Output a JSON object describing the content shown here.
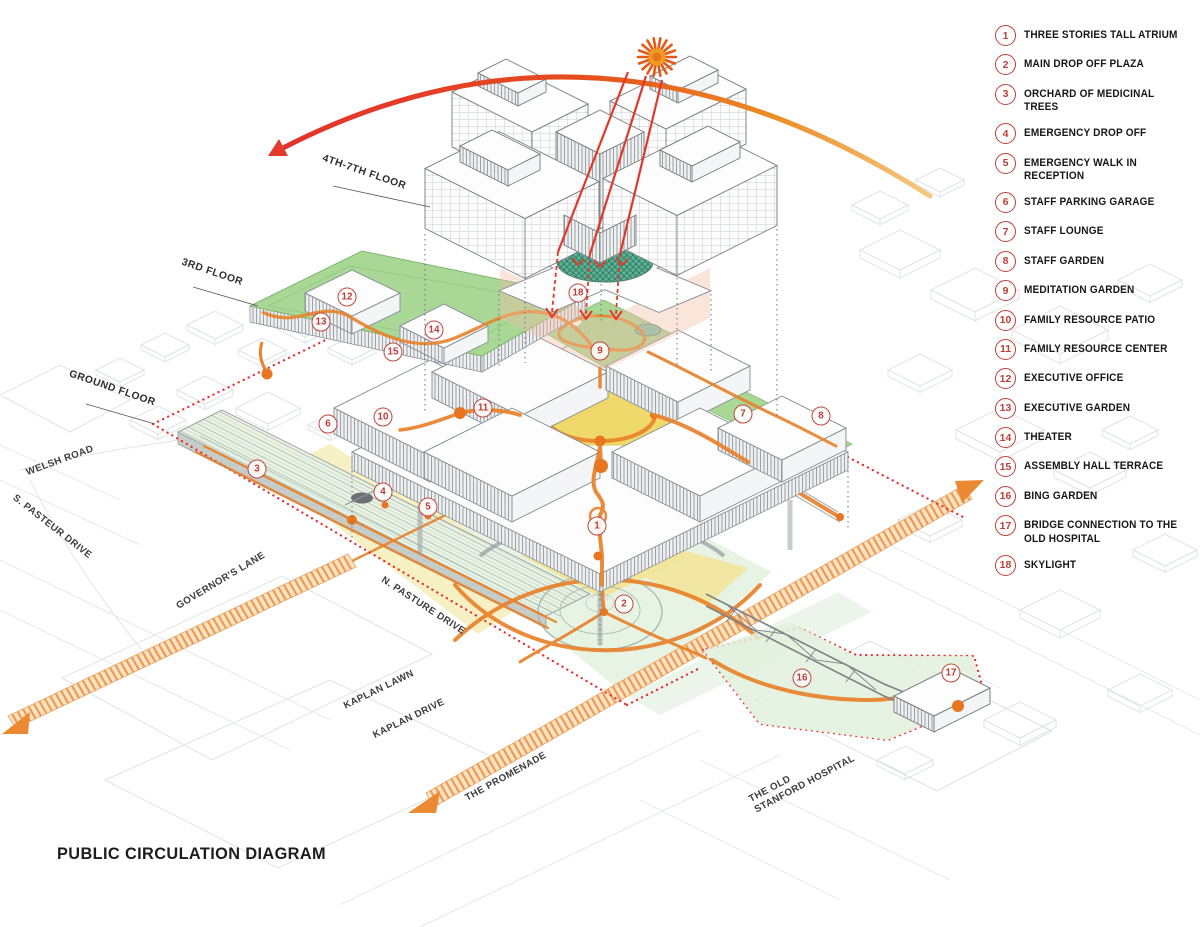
{
  "title": "PUBLIC CIRCULATION DIAGRAM",
  "legend": {
    "items": [
      {
        "num": "1",
        "label": "THREE STORIES TALL ATRIUM"
      },
      {
        "num": "2",
        "label": "MAIN DROP OFF PLAZA"
      },
      {
        "num": "3",
        "label": "ORCHARD OF MEDICINAL TREES"
      },
      {
        "num": "4",
        "label": "EMERGENCY DROP OFF"
      },
      {
        "num": "5",
        "label": "EMERGENCY WALK IN RECEPTION"
      },
      {
        "num": "6",
        "label": "STAFF PARKING GARAGE"
      },
      {
        "num": "7",
        "label": "STAFF LOUNGE"
      },
      {
        "num": "8",
        "label": "STAFF GARDEN"
      },
      {
        "num": "9",
        "label": "MEDITATION GARDEN"
      },
      {
        "num": "10",
        "label": "FAMILY RESOURCE PATIO"
      },
      {
        "num": "11",
        "label": "FAMILY RESOURCE CENTER"
      },
      {
        "num": "12",
        "label": "EXECUTIVE OFFICE"
      },
      {
        "num": "13",
        "label": "EXECUTIVE GARDEN"
      },
      {
        "num": "14",
        "label": "THEATER"
      },
      {
        "num": "15",
        "label": "ASSEMBLY HALL TERRACE"
      },
      {
        "num": "16",
        "label": "BING GARDEN"
      },
      {
        "num": "17",
        "label": "BRIDGE CONNECTION TO THE OLD HOSPITAL"
      },
      {
        "num": "18",
        "label": "SKYLIGHT"
      }
    ]
  },
  "diagram": {
    "floor_labels": [
      {
        "text": "4TH-7TH FLOOR",
        "x": 364,
        "y": 173,
        "rot": 19
      },
      {
        "text": "3RD FLOOR",
        "x": 212,
        "y": 273,
        "rot": 19
      },
      {
        "text": "GROUND FLOOR",
        "x": 112,
        "y": 389,
        "rot": 19
      }
    ],
    "street_labels": [
      {
        "text": "WELSH ROAD",
        "x": 60,
        "y": 461,
        "rot": -20
      },
      {
        "text": "S. PASTEUR DRIVE",
        "x": 52,
        "y": 527,
        "rot": 38
      },
      {
        "text": "GOVERNOR'S LANE",
        "x": 221,
        "y": 581,
        "rot": -31
      },
      {
        "text": "N. PASTURE DRIVE",
        "x": 423,
        "y": 606,
        "rot": 33
      },
      {
        "text": "KAPLAN LAWN",
        "x": 379,
        "y": 690,
        "rot": -26
      },
      {
        "text": "KAPLAN DRIVE",
        "x": 409,
        "y": 719,
        "rot": -26
      },
      {
        "text": "THE PROMENADE",
        "x": 506,
        "y": 777,
        "rot": -29
      },
      {
        "text": "THE OLD\nSTANFORD HOSPITAL",
        "x": 802,
        "y": 779,
        "rot": -28
      }
    ],
    "markers": [
      {
        "num": "1",
        "x": 597,
        "y": 526
      },
      {
        "num": "2",
        "x": 624,
        "y": 604
      },
      {
        "num": "3",
        "x": 257,
        "y": 469
      },
      {
        "num": "4",
        "x": 383,
        "y": 492
      },
      {
        "num": "5",
        "x": 428,
        "y": 507
      },
      {
        "num": "6",
        "x": 328,
        "y": 424
      },
      {
        "num": "7",
        "x": 743,
        "y": 414
      },
      {
        "num": "8",
        "x": 821,
        "y": 416
      },
      {
        "num": "9",
        "x": 600,
        "y": 351
      },
      {
        "num": "10",
        "x": 383,
        "y": 417
      },
      {
        "num": "11",
        "x": 483,
        "y": 408
      },
      {
        "num": "12",
        "x": 347,
        "y": 297
      },
      {
        "num": "13",
        "x": 321,
        "y": 322
      },
      {
        "num": "14",
        "x": 434,
        "y": 330
      },
      {
        "num": "15",
        "x": 393,
        "y": 352
      },
      {
        "num": "16",
        "x": 802,
        "y": 678
      },
      {
        "num": "17",
        "x": 951,
        "y": 673
      },
      {
        "num": "18",
        "x": 578,
        "y": 293
      }
    ]
  },
  "colors": {
    "path_orange": "#E8822B",
    "boundary_red": "#E8312F",
    "roof_green": "#A9D896",
    "ground_mint": "#E7F3E3",
    "plaza_yellow": "#F3E49B",
    "courtyard_yellow": "#EFD96B",
    "skylight_teal": "#3F9D82",
    "marker_red": "#BE3E38",
    "arc_red": "#E4312E",
    "arc_amber": "#F4C87E",
    "sun_orange": "#E8741C",
    "line_gray": "#8E9499"
  }
}
